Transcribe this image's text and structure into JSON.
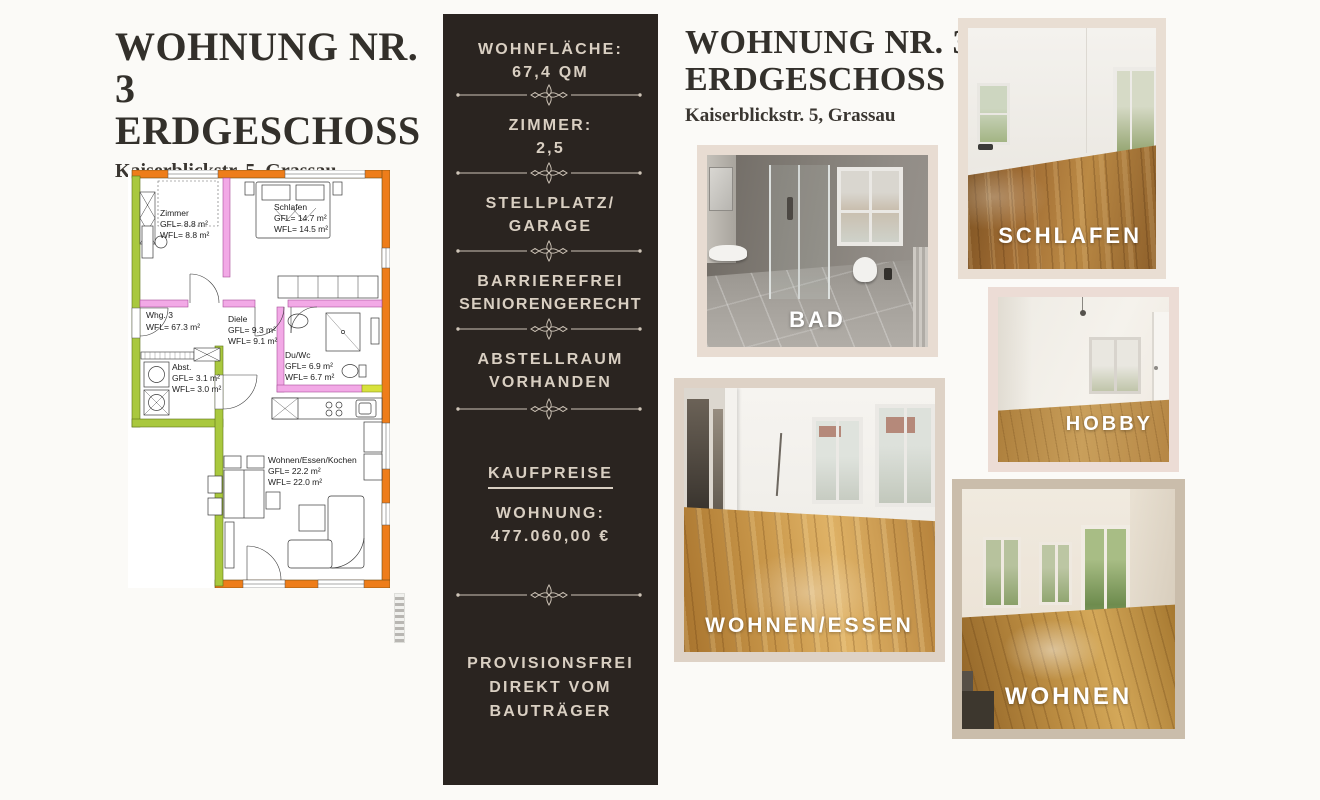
{
  "page": {
    "background": "#fbfaf7",
    "accent_dark": "#2a2420",
    "accent_cream": "#d9cfc2",
    "frame_color": "#e6dacf"
  },
  "left": {
    "title_line1": "WOHNUNG NR. 3",
    "title_line2": "ERDGESCHOSS",
    "subtitle": "Kaiserblickstr. 5, Grassau"
  },
  "floorplan": {
    "apartment_label": {
      "line1": "Whg. 3",
      "line2": "WFL= 67.3 m²"
    },
    "rooms": [
      {
        "name": "Zimmer",
        "gfl": "GFL= 8.8 m²",
        "wfl": "WFL= 8.8 m²"
      },
      {
        "name": "Schlafen",
        "gfl": "GFL= 14.7 m²",
        "wfl": "WFL= 14.5 m²"
      },
      {
        "name": "Diele",
        "gfl": "GFL= 9.3 m²",
        "wfl": "WFL= 9.1 m²"
      },
      {
        "name": "Du/Wc",
        "gfl": "GFL= 6.9 m²",
        "wfl": "WFL= 6.7 m²"
      },
      {
        "name": "Abst.",
        "gfl": "GFL= 3.1 m²",
        "wfl": "WFL= 3.0 m²"
      },
      {
        "name": "Wohnen/Essen/Kochen",
        "gfl": "GFL= 22.2 m²",
        "wfl": "WFL= 22.0 m²"
      }
    ],
    "colors": {
      "exterior_wall": "#ee7d1a",
      "interior_wall": "#f2a9e6",
      "new_wall_green": "#a9c83e",
      "yellow_wall": "#d8e23c"
    }
  },
  "info_panel": {
    "background": "#2a2420",
    "text_color": "#d9cfc2",
    "items": [
      {
        "label": "WOHNFLÄCHE:",
        "value": "67,4 QM"
      },
      {
        "label": "ZIMMER:",
        "value": "2,5"
      },
      {
        "label": "STELLPLATZ/",
        "value": "GARAGE"
      },
      {
        "label": "BARRIEREFREI",
        "value": "SENIORENGERECHT"
      },
      {
        "label": "ABSTELLRAUM",
        "value": "VORHANDEN"
      }
    ],
    "price_heading": "KAUFPREISE",
    "price_label": "WOHNUNG:",
    "price_value": "477.060,00 €",
    "footer_line1": "PROVISIONSFREI",
    "footer_line2": "DIREKT VOM",
    "footer_line3": "BAUTRÄGER"
  },
  "right": {
    "title_line1": "WOHNUNG NR. 3",
    "title_line2": "ERDGESCHOSS",
    "subtitle": "Kaiserblickstr. 5, Grassau",
    "photos": [
      {
        "label": "BAD"
      },
      {
        "label": "SCHLAFEN"
      },
      {
        "label": "HOBBY"
      },
      {
        "label": "WOHNEN/ESSEN"
      },
      {
        "label": "WOHNEN"
      }
    ]
  }
}
